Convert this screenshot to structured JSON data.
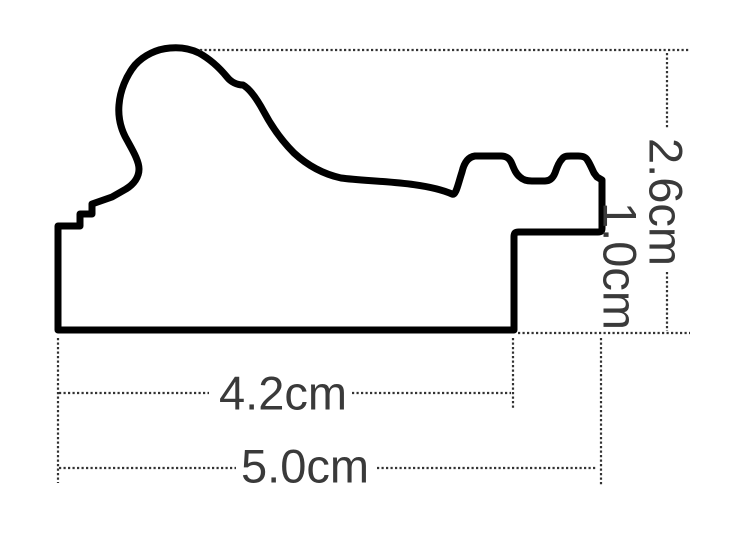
{
  "diagram": {
    "type": "cross-section-profile",
    "subject": "picture frame moulding profile with dimension annotations",
    "unit": "cm",
    "dimensions": {
      "total_height": {
        "label": "2.6cm",
        "value": 2.6,
        "unit": "cm",
        "orientation": "vertical"
      },
      "rabbet_height": {
        "label": "1.0cm",
        "value": 1.0,
        "unit": "cm",
        "orientation": "vertical"
      },
      "base_width": {
        "label": "4.2cm",
        "value": 4.2,
        "unit": "cm",
        "orientation": "horizontal"
      },
      "total_width": {
        "label": "5.0cm",
        "value": 5.0,
        "unit": "cm",
        "orientation": "horizontal"
      }
    },
    "colors": {
      "outline": "#000000",
      "dimension_lines": "#333333",
      "label_text": "#3a3a3a",
      "background": "#ffffff"
    }
  }
}
